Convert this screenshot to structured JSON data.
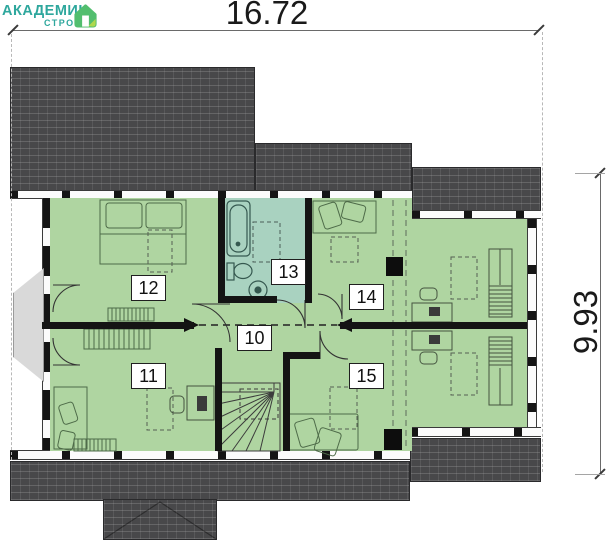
{
  "logo": {
    "brand": "АКАДЕМИК",
    "sub": "СТРОЙ",
    "icon": "house-icon",
    "brand_color": "#2EA79D",
    "icon_green": "#52BE6E",
    "icon_lime": "#AFD84D"
  },
  "dimensions": {
    "width": "16.72",
    "height": "9.93"
  },
  "floor_plan": {
    "rooms": [
      {
        "number": "10",
        "type": "hall-with-stairs"
      },
      {
        "number": "11",
        "type": "bedroom"
      },
      {
        "number": "12",
        "type": "bedroom"
      },
      {
        "number": "13",
        "type": "bathroom"
      },
      {
        "number": "14",
        "type": "room"
      },
      {
        "number": "15",
        "type": "room"
      }
    ],
    "colors": {
      "room_fill": "#AFD5A1",
      "bathroom_fill": "#A9D2C0",
      "roof": "#48484A",
      "wall": "#141414",
      "balcony": "#D9D9D9"
    }
  }
}
